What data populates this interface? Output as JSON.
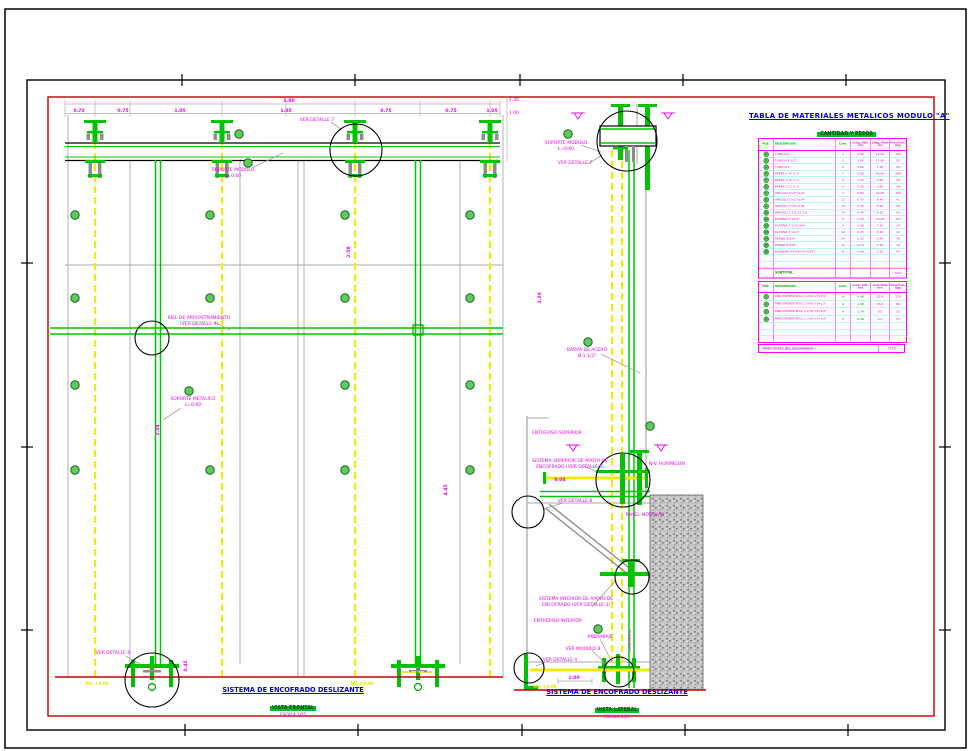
{
  "table_block": {
    "title": "TABLA DE MATERIALES METALICOS MODULO \"A\"",
    "subtitle": "CANTIDAD Y PESOS",
    "headers": {
      "pos": "POS.",
      "desc": "DESCRIPCION",
      "cant": "Cant.",
      "long_unit": "Long. Unit. (m)",
      "long_total": "Long. Total (m)",
      "peso": "Peso Parc. (kg)"
    },
    "rows": [
      {
        "pos": "1",
        "desc": "TUBO Ø 2\"",
        "cant": "4",
        "lu": "5.80",
        "lt": "23.20",
        "peso": "163"
      },
      {
        "pos": "2",
        "desc": "TUBO Ø 1 1/2\"",
        "cant": "2",
        "lu": "5.80",
        "lt": "11.60",
        "peso": "85"
      },
      {
        "pos": "3",
        "desc": "TUBO Ø 1\"",
        "cant": "2",
        "lu": "3.60",
        "lt": "7.20",
        "peso": "36"
      },
      {
        "pos": "4",
        "desc": "PERFIL C 6\" x 2\"",
        "cant": "7",
        "lu": "5.80",
        "lt": "40.60",
        "peso": "580"
      },
      {
        "pos": "5",
        "desc": "PERFIL C 4\" x 2\"",
        "cant": "4",
        "lu": "1.20",
        "lt": "4.80",
        "peso": "58"
      },
      {
        "pos": "6",
        "desc": "PERFIL C 3\" x 2\"",
        "cant": "6",
        "lu": "0.60",
        "lt": "3.60",
        "peso": "38"
      },
      {
        "pos": "7",
        "desc": "ANGULO 3\"x3\"x1/4\"",
        "cant": "7",
        "lu": "5.80",
        "lt": "40.60",
        "peso": "300"
      },
      {
        "pos": "8",
        "desc": "ANGULO 2\"x2\"x1/4\"",
        "cant": "12",
        "lu": "0.70",
        "lt": "8.40",
        "peso": "41"
      },
      {
        "pos": "9",
        "desc": "ANGULO 2\"x2\"x1/8\"",
        "cant": "14",
        "lu": "0.35",
        "lt": "4.90",
        "peso": "24"
      },
      {
        "pos": "10",
        "desc": "ANGULO 1 1/2\"x1 1/2\"",
        "cant": "14",
        "lu": "0.45",
        "lt": "6.30",
        "peso": "25"
      },
      {
        "pos": "11",
        "desc": "PLATINA 2\"x1/4\"",
        "cant": "8",
        "lu": "2.50",
        "lt": "20.00",
        "peso": "127"
      },
      {
        "pos": "12",
        "desc": "PLATINA 1 1/2\"x1/4\"",
        "cant": "4",
        "lu": "1.80",
        "lt": "7.20",
        "peso": "33"
      },
      {
        "pos": "13",
        "desc": "PLATINA 1\"x1/4\"",
        "cant": "14",
        "lu": "0.25",
        "lt": "3.50",
        "peso": "12"
      },
      {
        "pos": "14",
        "desc": "PERNO Ø 3/4\"",
        "cant": "24",
        "lu": "0.10",
        "lt": "2.40",
        "peso": "18"
      },
      {
        "pos": "15",
        "desc": "PERNO Ø 5/8\"",
        "cant": "14",
        "lu": "0.14",
        "lt": "1.96",
        "peso": "10"
      },
      {
        "pos": "16",
        "desc": "PLANCHA A=0.40 E=3/16\"",
        "cant": "8",
        "lu": "0.40",
        "lt": "3.20",
        "peso": "95"
      }
    ],
    "subtotal_label": "SUBTOTAL",
    "subtotal_value": "2997"
  },
  "wood_table": {
    "headers": {
      "pos": "POS.",
      "desc": "DESCRIPCION",
      "cant": "Cant.",
      "long_unit": "Long. Unit. (m)",
      "area_total": "Area Total (m²)",
      "peso": "Peso Parc. (kg)"
    },
    "rows": [
      {
        "pos": "1",
        "desc": "PAÑO MADERA PLAC. C 4'x8' x E=3/4\"",
        "cant": "14",
        "lu": "4.48",
        "lt": "62.8",
        "peso": "219"
      },
      {
        "pos": "2",
        "desc": "PAÑO MADERA PLAC. C 4'x8' x E=1/2\"",
        "cant": "6",
        "lu": "4.48",
        "lt": "26.9",
        "peso": "80"
      },
      {
        "pos": "3",
        "desc": "PAÑO MADERA PLAC. C 2'x8' x E=3/4\"",
        "cant": "4",
        "lu": "2.24",
        "lt": "9.0",
        "peso": "31"
      },
      {
        "pos": "4",
        "desc": "PAÑO MADERA PLAC. C 2'x8' x E=1/2\"",
        "cant": "2",
        "lu": "4.48",
        "lt": "9.0",
        "peso": "27"
      }
    ]
  },
  "total_bar": {
    "label": "PESO TOTAL DEL ENCOFRADO =",
    "value": "7718"
  },
  "titles": {
    "frontal_main": "SISTEMA DE ENCOFRADO DESLIZANTE",
    "frontal_sub": "VISTA FRONTAL",
    "frontal_scale": "ESCALA 1/25",
    "lateral_main": "SISTEMA DE ENCOFRADO DESLIZANTE",
    "lateral_sub": "VISTA LATERAL",
    "lateral_scale": "ESCALA 1/25"
  },
  "labels": {
    "ver_detalle_7": "VER DETALLE 7",
    "soporte_modulo_a": "SOPORTE MODULO",
    "soporte_modulo_b": "L=0.60",
    "riel_a": "RIEL DE ARRIOSTRAMIENTO",
    "riel_b": "(VER DETALLE 4)",
    "soporte_metalico_a": "SOPORTE METALICO",
    "soporte_metalico_b": "L=0.60",
    "ver_detalle_6": "VER DETALLE 6",
    "lat_soporte_a": "SOPORTE MODULO",
    "lat_soporte_b": "L=0.60",
    "lat_ver_detalle_7": "VER DETALLE 7",
    "barra_acero_a": "BARRA DE ACERO",
    "barra_acero_b": "Ø 1 1/2\"",
    "entrepiso_sup": "ENTREPISO SUPERIOR",
    "sistema_sup_a": "SISTEMA SUPERIOR DE APOYO DE",
    "sistema_sup_b": "ENCOFRADO (VER DETALLE 5)",
    "niv_hormigon": "NIV. HORMIGON",
    "ver_detalle_8": "VER DETALLE 8",
    "panel_modular": "PANEL MODULAR",
    "sistema_inf_a": "SISTEMA INFERIOR DE APOYO DE",
    "sistema_inf_b": "ENCOFRADO (VER DETALLE 3)",
    "entrepiso_inf": "ENTREPISO INFERIOR",
    "andamiaje": "ANDAMIAJE",
    "compuerta": "COMPUERTA",
    "ver_modulo_b": "VER MODULO B",
    "ver_detalle_4": "VER DETALLE 4",
    "nv_left": "NV. ±0.00",
    "nv_mid": "NV. ±0.00",
    "nv_lat": "NV. ±0.00"
  },
  "dims": {
    "d580": "5.80",
    "top": [
      "0.75",
      "0.75",
      "1.05",
      "1.05",
      "0.75",
      "0.75",
      "1.05"
    ],
    "right_a": "1.30",
    "right_b": "1.00",
    "r258": "2.58",
    "r445": "4.45",
    "r204": "2.04",
    "r045": "0.45",
    "r330": "3.30",
    "d004": "0.04",
    "d100": "1.00"
  }
}
